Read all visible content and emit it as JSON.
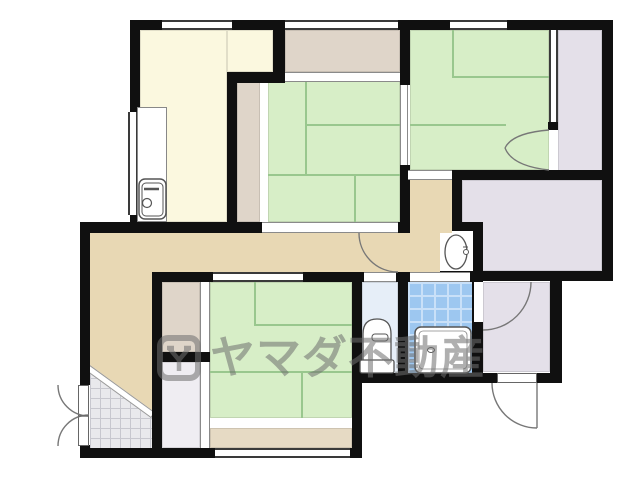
{
  "watermark": {
    "text": "ヤマダ不動産",
    "logo": "yamada-crest-logo"
  },
  "colors": {
    "wall": "#101010",
    "tatami": "#D7EEC7",
    "tatami_line": "#99C78E",
    "cream": "#FBF8DF",
    "closet_tan": "#DFD5C9",
    "hall": "#E8D8B4",
    "engawa": "#E6DAC4",
    "lavender": "#E4E0E9",
    "closet_grey": "#EFEDF2",
    "toilet": "#E6EEF8",
    "bath_tile": "#9DC7F0",
    "bath_tile_line": "#C9E0F8",
    "genkan_tile": "#E9E9EC",
    "genkan_tile_line": "#C7C7CE",
    "watermark": "#6F6F6F"
  }
}
